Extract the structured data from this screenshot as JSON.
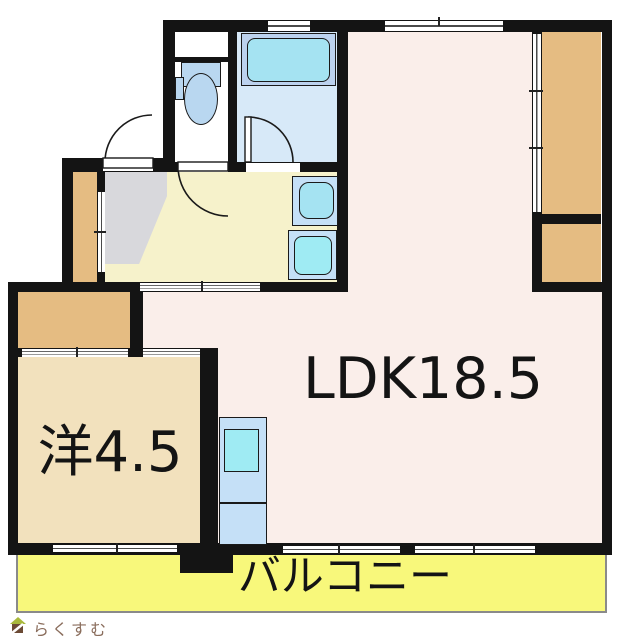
{
  "labels": {
    "ldk": "LDK18.5",
    "western_room": "洋4.5",
    "balcony": "バルコニー",
    "logo": "らくすむ"
  },
  "fixtures": {
    "toilet": "toilet",
    "bathtub": "bathtub",
    "washbasin": "washbasin",
    "washing_machine": "washing-machine-pan",
    "kitchen": "kitchen-counter",
    "entrance": "genkan-entrance",
    "closets": [
      "closet-western-room",
      "shoe-closet",
      "storage-upper-right",
      "storage-lower-right"
    ]
  },
  "palette": {
    "wall": "#141414",
    "ldk_floor": "#faeeea",
    "western_floor": "#f2e1bd",
    "hall_floor": "#f6f2cb",
    "bath_floor": "#d7e9f8",
    "closet": "#e5bc82",
    "genkan": "#d8d8dc",
    "balcony": "#f8f87b",
    "fixture_blue": "#c5e0f7",
    "fixture_cyan": "#9febf3",
    "tub_frame": "#bcd2ee",
    "tub_cyan": "#a5e3f2",
    "toilet_blue": "#b9d7f0",
    "outline_gray": "#8a8a8a",
    "logo_brown": "#8a6d5c",
    "logo_roof": "#a9b93c",
    "logo_body": "#6b4a35"
  }
}
